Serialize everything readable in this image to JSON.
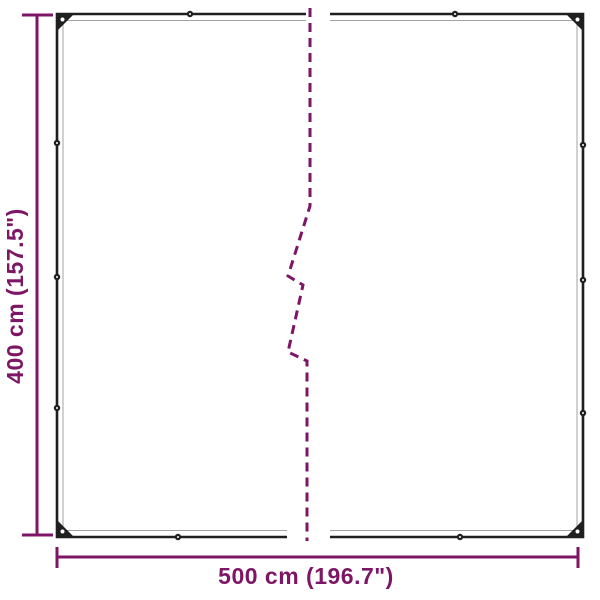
{
  "diagram": {
    "kind": "product-dimension-diagram",
    "height_label": "400 cm (157.5\")",
    "width_label": "500 cm (196.7\")",
    "colors": {
      "dimension_accent": "#7c1665",
      "tarp_outline": "#1f1f1f",
      "tarp_hem": "#a3a3a3",
      "background": "#ffffff"
    },
    "icons": {
      "grommet": "filled circle with white pinhole",
      "corner_grommet": "dark corner triangle with white pinhole",
      "break_line": "dashed zigzag continuation line"
    }
  }
}
